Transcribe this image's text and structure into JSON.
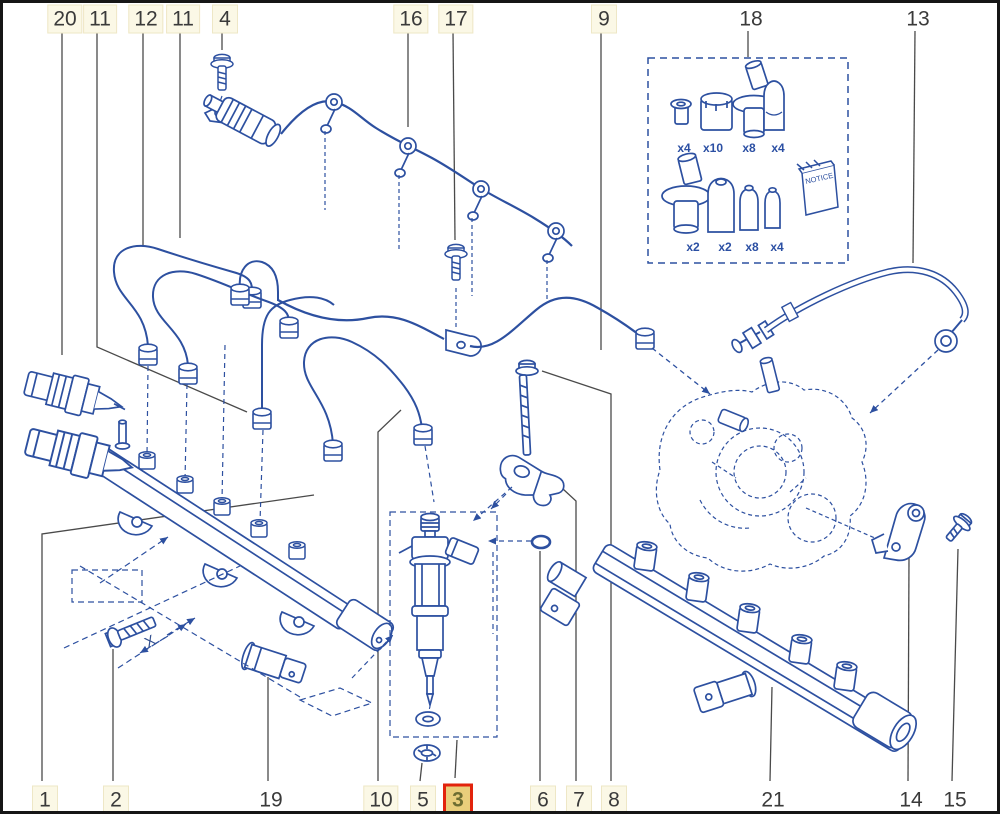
{
  "colors": {
    "art_blue": "#2d50a0",
    "leader_gray": "#4a4a4a",
    "callout_bg": "#fbf8e6",
    "callout_border": "#eee7c6",
    "callout_text": "#3a3a3a",
    "highlight_bg": "#e9ce7b",
    "highlight_border": "#e2230c",
    "highlight_text": "#6d6d31",
    "frame": "#161616"
  },
  "callouts": [
    {
      "text": "20",
      "x": 62,
      "y": 16,
      "boxed": true,
      "highlighted": false,
      "leader": [
        [
          62,
          31
        ],
        [
          62,
          355
        ]
      ]
    },
    {
      "text": "11",
      "x": 97,
      "y": 16,
      "boxed": true,
      "highlighted": false,
      "leader": [
        [
          97,
          31
        ],
        [
          97,
          347
        ],
        [
          247,
          412
        ]
      ]
    },
    {
      "text": "12",
      "x": 143,
      "y": 16,
      "boxed": true,
      "highlighted": false,
      "leader": [
        [
          143,
          31
        ],
        [
          143,
          246
        ]
      ]
    },
    {
      "text": "11",
      "x": 180,
      "y": 16,
      "boxed": true,
      "highlighted": false,
      "leader": [
        [
          180,
          31
        ],
        [
          180,
          238
        ]
      ]
    },
    {
      "text": "4",
      "x": 222,
      "y": 16,
      "boxed": true,
      "highlighted": false,
      "leader": [
        [
          222,
          31
        ],
        [
          222,
          50
        ]
      ]
    },
    {
      "text": "16",
      "x": 408,
      "y": 16,
      "boxed": true,
      "highlighted": false,
      "leader": [
        [
          408,
          31
        ],
        [
          408,
          127
        ]
      ]
    },
    {
      "text": "17",
      "x": 453,
      "y": 16,
      "boxed": true,
      "highlighted": false,
      "leader": [
        [
          453,
          31
        ],
        [
          455,
          240
        ]
      ]
    },
    {
      "text": "9",
      "x": 601,
      "y": 16,
      "boxed": true,
      "highlighted": false,
      "leader": [
        [
          601,
          31
        ],
        [
          601,
          350
        ]
      ]
    },
    {
      "text": "18",
      "x": 748,
      "y": 16,
      "boxed": false,
      "highlighted": false,
      "leader": [
        [
          748,
          31
        ],
        [
          748,
          57
        ]
      ]
    },
    {
      "text": "13",
      "x": 915,
      "y": 16,
      "boxed": false,
      "highlighted": false,
      "leader": [
        [
          915,
          31
        ],
        [
          913,
          263
        ]
      ]
    },
    {
      "text": "1",
      "x": 42,
      "y": 797,
      "boxed": true,
      "highlighted": false,
      "leader": [
        [
          42,
          781
        ],
        [
          42,
          534
        ],
        [
          314,
          495
        ]
      ]
    },
    {
      "text": "2",
      "x": 113,
      "y": 797,
      "boxed": true,
      "highlighted": false,
      "leader": [
        [
          113,
          781
        ],
        [
          113,
          649
        ]
      ]
    },
    {
      "text": "19",
      "x": 268,
      "y": 797,
      "boxed": false,
      "highlighted": false,
      "leader": [
        [
          268,
          781
        ],
        [
          268,
          677
        ]
      ]
    },
    {
      "text": "10",
      "x": 378,
      "y": 797,
      "boxed": true,
      "highlighted": false,
      "leader": [
        [
          378,
          781
        ],
        [
          378,
          432
        ],
        [
          401,
          410
        ]
      ]
    },
    {
      "text": "5",
      "x": 420,
      "y": 797,
      "boxed": true,
      "highlighted": false,
      "leader": [
        [
          420,
          781
        ],
        [
          422,
          763
        ]
      ]
    },
    {
      "text": "3",
      "x": 455,
      "y": 797,
      "boxed": false,
      "highlighted": true,
      "leader": [
        [
          455,
          778
        ],
        [
          457,
          740
        ]
      ]
    },
    {
      "text": "6",
      "x": 540,
      "y": 797,
      "boxed": true,
      "highlighted": false,
      "leader": [
        [
          540,
          781
        ],
        [
          540,
          551
        ]
      ]
    },
    {
      "text": "7",
      "x": 576,
      "y": 797,
      "boxed": true,
      "highlighted": false,
      "leader": [
        [
          576,
          781
        ],
        [
          576,
          501
        ],
        [
          563,
          489
        ]
      ]
    },
    {
      "text": "8",
      "x": 611,
      "y": 797,
      "boxed": true,
      "highlighted": false,
      "leader": [
        [
          611,
          781
        ],
        [
          611,
          394
        ],
        [
          542,
          371
        ]
      ]
    },
    {
      "text": "21",
      "x": 770,
      "y": 797,
      "boxed": false,
      "highlighted": false,
      "leader": [
        [
          770,
          781
        ],
        [
          772,
          687
        ]
      ]
    },
    {
      "text": "14",
      "x": 908,
      "y": 797,
      "boxed": false,
      "highlighted": false,
      "leader": [
        [
          908,
          781
        ],
        [
          909,
          558
        ]
      ]
    },
    {
      "text": "15",
      "x": 952,
      "y": 797,
      "boxed": false,
      "highlighted": false,
      "leader": [
        [
          952,
          781
        ],
        [
          958,
          549
        ]
      ]
    }
  ],
  "parts_box": {
    "notice_label": "NOTICE",
    "items": [
      {
        "name": "plug-cap-small",
        "count": "x4",
        "x": 681,
        "y": 145
      },
      {
        "name": "plug-cap-medium",
        "count": "x10",
        "x": 710,
        "y": 145
      },
      {
        "name": "sealing-plug-flanged",
        "count": "x8",
        "x": 746,
        "y": 145
      },
      {
        "name": "cap-tall",
        "count": "x4",
        "x": 775,
        "y": 145
      },
      {
        "name": "sealing-plug-flanged-large",
        "count": "x2",
        "x": 690,
        "y": 244
      },
      {
        "name": "cap-medium",
        "count": "x2",
        "x": 722,
        "y": 244
      },
      {
        "name": "cap-small",
        "count": "x8",
        "x": 749,
        "y": 244
      },
      {
        "name": "cap-xsmall",
        "count": "x4",
        "x": 774,
        "y": 244
      }
    ]
  },
  "annotations": {
    "x_mark": "X"
  }
}
